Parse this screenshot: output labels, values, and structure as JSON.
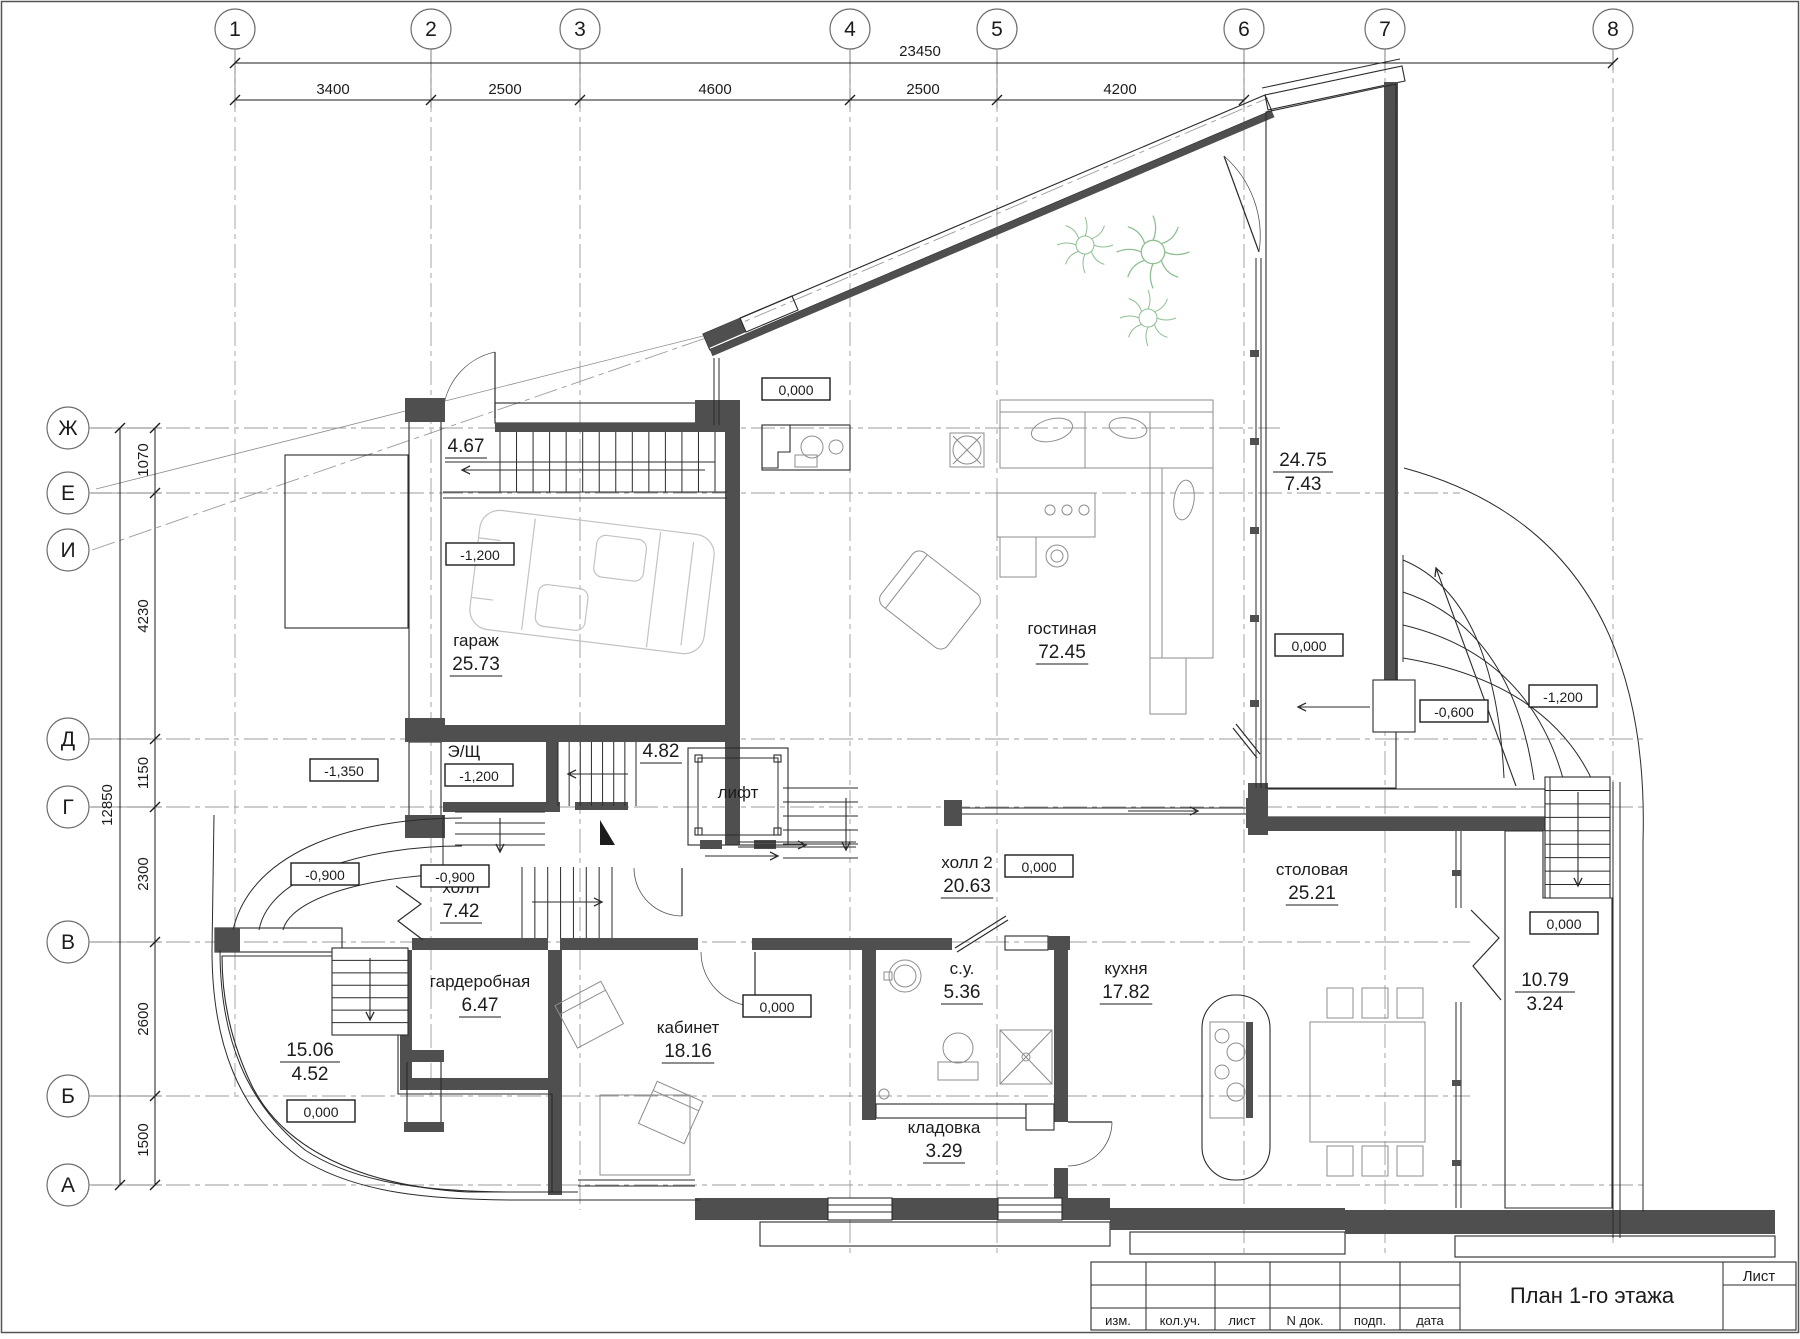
{
  "drawing_title": "План 1-го этажа",
  "axes": {
    "vertical": [
      {
        "label": "1",
        "x": 235
      },
      {
        "label": "2",
        "x": 431
      },
      {
        "label": "3",
        "x": 580
      },
      {
        "label": "4",
        "x": 850
      },
      {
        "label": "5",
        "x": 997
      },
      {
        "label": "6",
        "x": 1244
      },
      {
        "label": "7",
        "x": 1385
      },
      {
        "label": "8",
        "x": 1613
      }
    ],
    "horizontal": [
      {
        "label": "Ж",
        "y": 428
      },
      {
        "label": "Е",
        "y": 493
      },
      {
        "label": "И",
        "y": 550
      },
      {
        "label": "Д",
        "y": 739
      },
      {
        "label": "Г",
        "y": 807
      },
      {
        "label": "В",
        "y": 942
      },
      {
        "label": "Б",
        "y": 1096
      },
      {
        "label": "А",
        "y": 1185
      }
    ]
  },
  "dimensions": {
    "top_total": {
      "value": "23450",
      "x": 920,
      "y": 56
    },
    "top_segments": [
      {
        "value": "3400",
        "x": 333
      },
      {
        "value": "2500",
        "x": 505
      },
      {
        "value": "4600",
        "x": 715
      },
      {
        "value": "2500",
        "x": 923
      },
      {
        "value": "4200",
        "x": 1120
      }
    ],
    "left_total": {
      "value": "12850",
      "x": 112,
      "y": 805
    },
    "left_segments": [
      {
        "value": "1070",
        "y": 460
      },
      {
        "value": "4230",
        "y": 616
      },
      {
        "value": "1150",
        "y": 773
      },
      {
        "value": "2300",
        "y": 874
      },
      {
        "value": "2600",
        "y": 1019
      },
      {
        "value": "1500",
        "y": 1140
      }
    ]
  },
  "rooms": [
    {
      "name": "гараж",
      "area": "25.73",
      "x": 476,
      "y": 646
    },
    {
      "name": "гостиная",
      "area": "72.45",
      "x": 1062,
      "y": 634
    },
    {
      "name": "холл",
      "area": "7.42",
      "x": 461,
      "y": 893
    },
    {
      "name": "холл 2",
      "area": "20.63",
      "x": 967,
      "y": 868
    },
    {
      "name": "гардеробная",
      "area": "6.47",
      "x": 480,
      "y": 987
    },
    {
      "name": "кабинет",
      "area": "18.16",
      "x": 688,
      "y": 1033
    },
    {
      "name": "с.у.",
      "area": "5.36",
      "x": 962,
      "y": 974
    },
    {
      "name": "кладовка",
      "area": "3.29",
      "x": 944,
      "y": 1133
    },
    {
      "name": "кухня",
      "area": "17.82",
      "x": 1126,
      "y": 974
    },
    {
      "name": "столовая",
      "area": "25.21",
      "x": 1312,
      "y": 875
    },
    {
      "name": "Э/Щ",
      "area": "",
      "x": 464,
      "y": 757
    },
    {
      "name": "лифт",
      "area": "",
      "x": 738,
      "y": 798
    },
    {
      "name": "",
      "area": "4.67",
      "x": 466,
      "y": 452
    },
    {
      "name": "",
      "area": "4.82",
      "x": 661,
      "y": 757
    }
  ],
  "terraces": [
    {
      "upper": "24.75",
      "lower": "7.43",
      "x": 1303,
      "y": 466
    },
    {
      "upper": "15.06",
      "lower": "4.52",
      "x": 310,
      "y": 1056
    },
    {
      "upper": "10.79",
      "lower": "3.24",
      "x": 1545,
      "y": 986
    }
  ],
  "elevations": [
    {
      "value": "0,000",
      "x": 796,
      "y": 390
    },
    {
      "value": "0,000",
      "x": 1039,
      "y": 867
    },
    {
      "value": "0,000",
      "x": 777,
      "y": 1007
    },
    {
      "value": "0,000",
      "x": 321,
      "y": 1112
    },
    {
      "value": "0,000",
      "x": 1309,
      "y": 646
    },
    {
      "value": "0,000",
      "x": 1564,
      "y": 924
    },
    {
      "value": "-1,200",
      "x": 480,
      "y": 555
    },
    {
      "value": "-1,200",
      "x": 479,
      "y": 776
    },
    {
      "value": "-1,350",
      "x": 344,
      "y": 771
    },
    {
      "value": "-0,900",
      "x": 325,
      "y": 875
    },
    {
      "value": "-0,900",
      "x": 455,
      "y": 877
    },
    {
      "value": "-0,600",
      "x": 1454,
      "y": 712
    },
    {
      "value": "-1,200",
      "x": 1563,
      "y": 697
    }
  ],
  "title_block": {
    "title": "План 1-го этажа",
    "sheet_label": "Лист",
    "columns": [
      "изм.",
      "кол.уч.",
      "лист",
      "N док.",
      "подп.",
      "дата"
    ]
  }
}
